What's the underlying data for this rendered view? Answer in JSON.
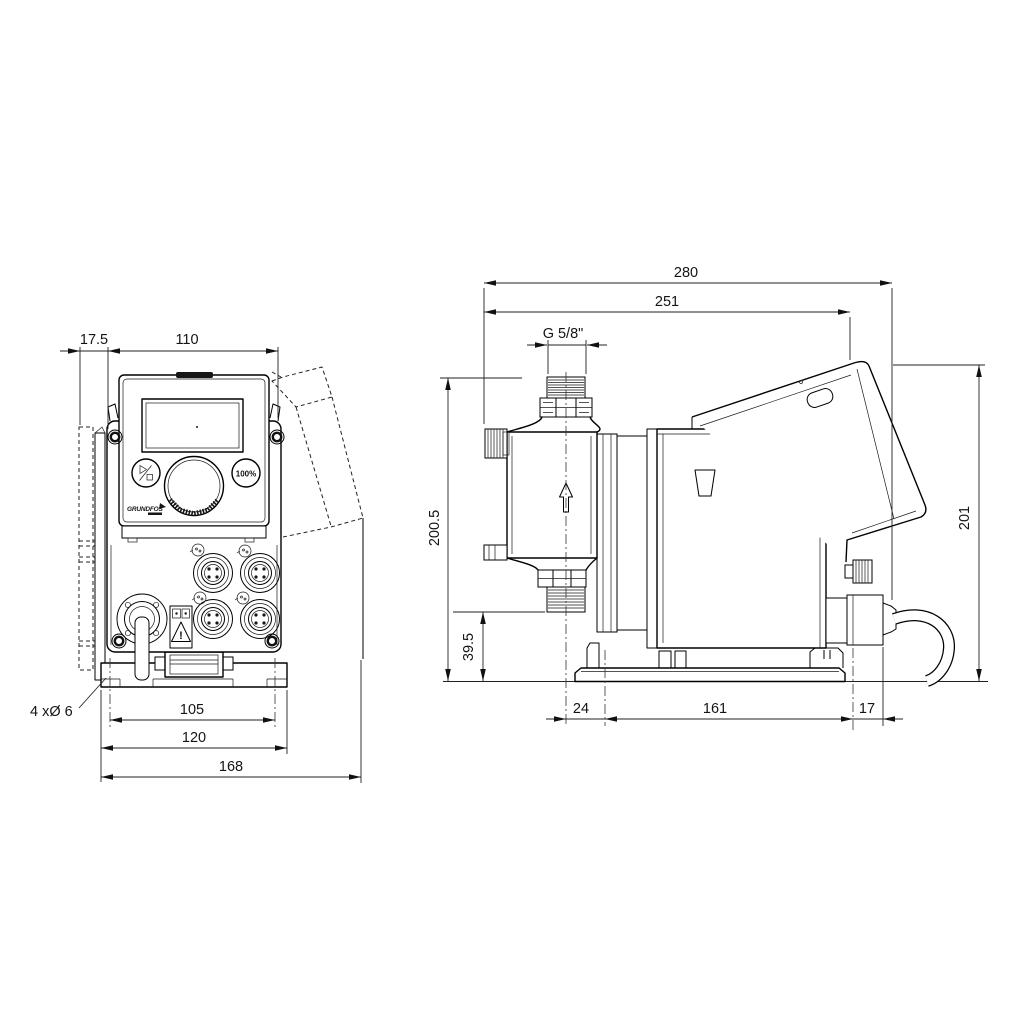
{
  "front_view": {
    "dims": {
      "offset": "17.5",
      "width": "110",
      "hole_spacing": "105",
      "plate_width": "120",
      "total_width": "168"
    },
    "note_holes": "4 xØ 6",
    "panel": {
      "button_full": "100%",
      "brand": "GRUNDFOS",
      "warning": "!"
    }
  },
  "side_view": {
    "dims": {
      "total_depth": "280",
      "body_depth": "251",
      "thread": "G 5/8\"",
      "height": "200.5",
      "valve_height": "39.5",
      "cover_height": "201",
      "base_front": "24",
      "base_length": "161",
      "base_rear": "17"
    }
  }
}
